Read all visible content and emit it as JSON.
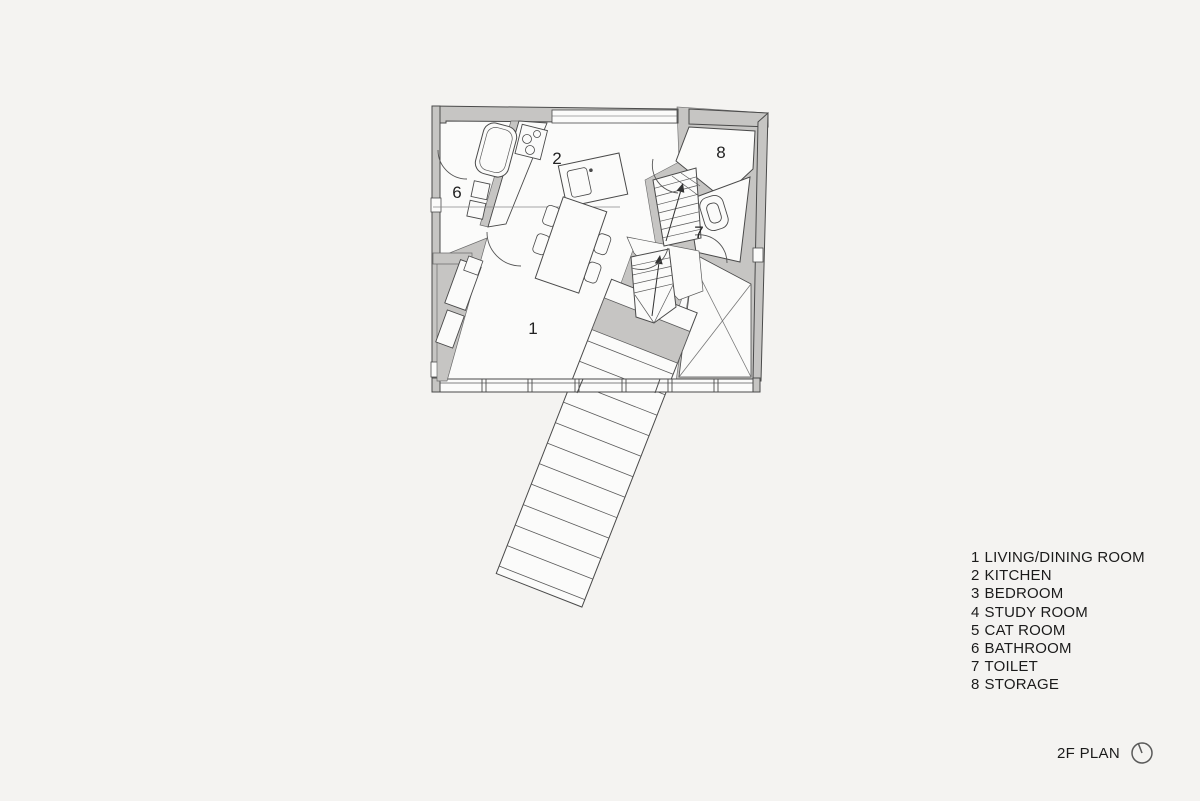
{
  "colors": {
    "background": "#f4f3f1",
    "wall_fill": "#c6c5c3",
    "line": "#4a4a4a",
    "floor_fill": "#fbfbfa"
  },
  "title": {
    "label": "2F PLAN",
    "icon": "north-arrow-icon"
  },
  "legend": {
    "items": [
      {
        "number": "1",
        "name": "LIVING/DINING ROOM"
      },
      {
        "number": "2",
        "name": "KITCHEN"
      },
      {
        "number": "3",
        "name": "BEDROOM"
      },
      {
        "number": "4",
        "name": "STUDY ROOM"
      },
      {
        "number": "5",
        "name": "CAT ROOM"
      },
      {
        "number": "6",
        "name": "BATHROOM"
      },
      {
        "number": "7",
        "name": "TOILET"
      },
      {
        "number": "8",
        "name": "STORAGE"
      }
    ]
  },
  "plan": {
    "room_labels": [
      {
        "number": "1",
        "room": "living-dining-room"
      },
      {
        "number": "2",
        "room": "kitchen"
      },
      {
        "number": "6",
        "room": "bathroom"
      },
      {
        "number": "7",
        "room": "toilet"
      },
      {
        "number": "8",
        "room": "storage"
      }
    ]
  }
}
